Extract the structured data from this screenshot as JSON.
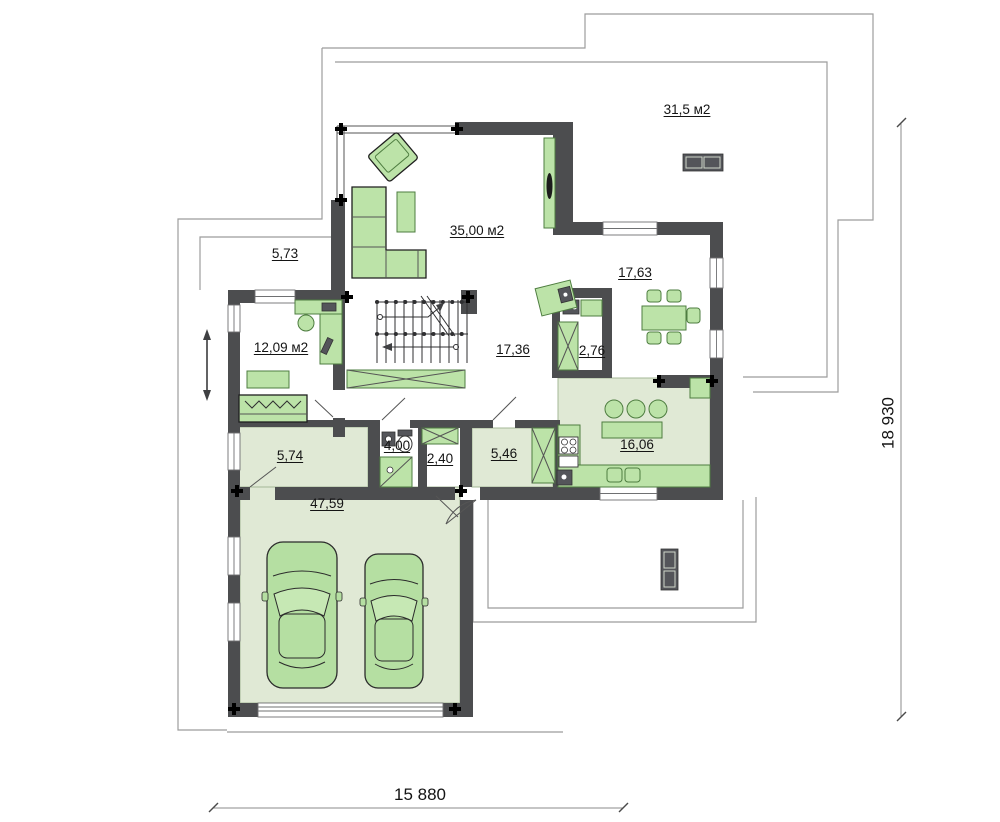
{
  "rooms": [
    {
      "name": "upper-terrace",
      "label": "31,5 м2"
    },
    {
      "name": "living-room",
      "label": "35,00 м2"
    },
    {
      "name": "left-balcony",
      "label": "5,73"
    },
    {
      "name": "dining-room",
      "label": "17,63"
    },
    {
      "name": "study",
      "label": "12,09 м2"
    },
    {
      "name": "hall",
      "label": "17,36"
    },
    {
      "name": "pantry",
      "label": "2,76"
    },
    {
      "name": "laundry",
      "label": "5,74"
    },
    {
      "name": "bathroom",
      "label": "4,00"
    },
    {
      "name": "entry",
      "label": "2,40"
    },
    {
      "name": "vestibule",
      "label": "5,46"
    },
    {
      "name": "kitchen",
      "label": "16,06"
    },
    {
      "name": "garage",
      "label": "47,59"
    }
  ],
  "dimensions": {
    "width": "15 880",
    "height": "18 930"
  },
  "colors": {
    "wall": "#4c4d4f",
    "furn": "#bce3a8",
    "furnb": "#4e7d40",
    "tint": "#e0e9d5",
    "tintb": "#a5b897",
    "outline": "#9c9c9c",
    "car": "#b5dfa2",
    "dark": "#54555a",
    "ink": "#141414",
    "winline": "#6f7072",
    "stair": "#2f2f31"
  }
}
